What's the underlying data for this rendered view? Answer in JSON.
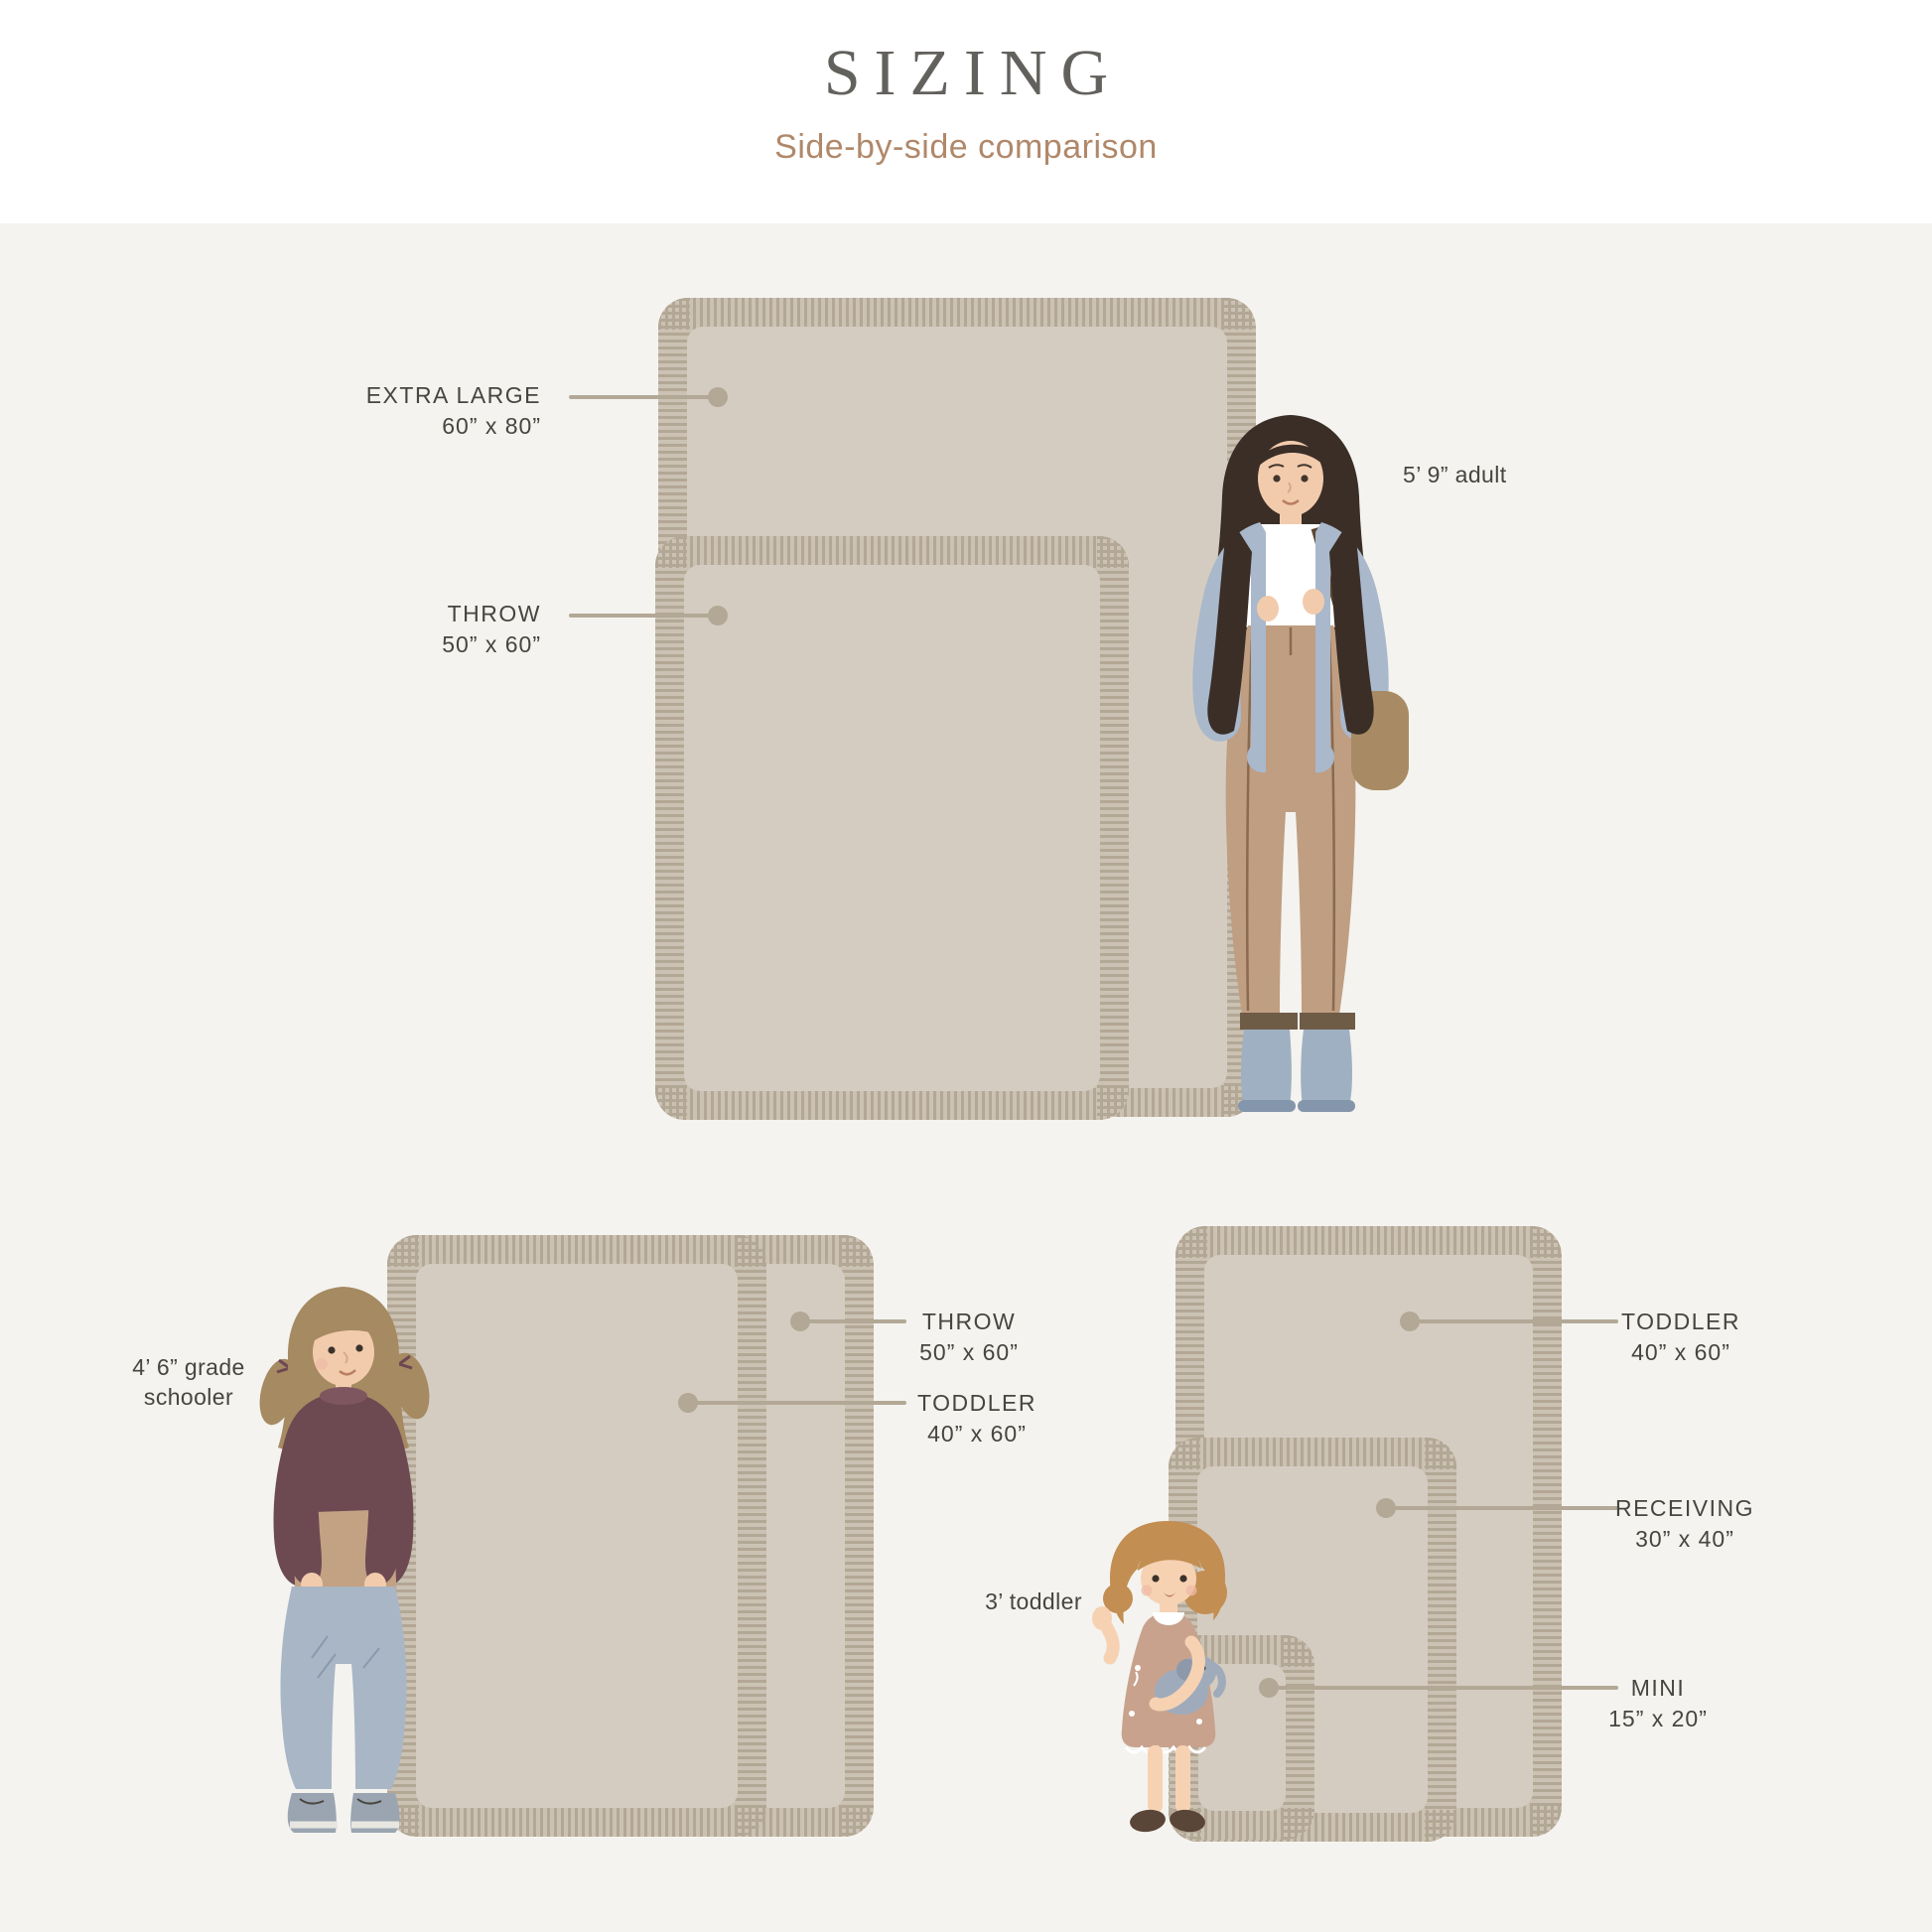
{
  "header": {
    "title": "SIZING",
    "subtitle": "Side-by-side comparison"
  },
  "top_section": {
    "blankets": [
      {
        "id": "extra-large",
        "label": "EXTRA LARGE",
        "size": "60” x 80”"
      },
      {
        "id": "throw",
        "label": "THROW",
        "size": "50” x 60”"
      }
    ],
    "person_label": "5’ 9” adult"
  },
  "bottom_left_section": {
    "person_label_line1": "4’ 6” grade",
    "person_label_line2": "schooler",
    "labels": [
      {
        "id": "throw",
        "label": "THROW",
        "size": "50” x 60”"
      },
      {
        "id": "toddler",
        "label": "TODDLER",
        "size": "40” x 60”"
      }
    ]
  },
  "bottom_right_section": {
    "person_label": "3’ toddler",
    "labels": [
      {
        "id": "toddler",
        "label": "TODDLER",
        "size": "40” x 60”"
      },
      {
        "id": "receiving",
        "label": "RECEIVING",
        "size": "30” x 40”"
      },
      {
        "id": "mini",
        "label": "MINI",
        "size": "15” x 20”"
      }
    ]
  },
  "colors": {
    "page_background": "#f4f3ef",
    "header_background": "#ffffff",
    "title_text": "#63615d",
    "subtitle_text": "#b0886a",
    "label_text": "#47453f",
    "leader_line": "#b3a896",
    "blanket_body": "#d5ccc1",
    "blanket_fringe": "#cbc2b3",
    "blanket_fringe_stripe": "#b3a795"
  }
}
